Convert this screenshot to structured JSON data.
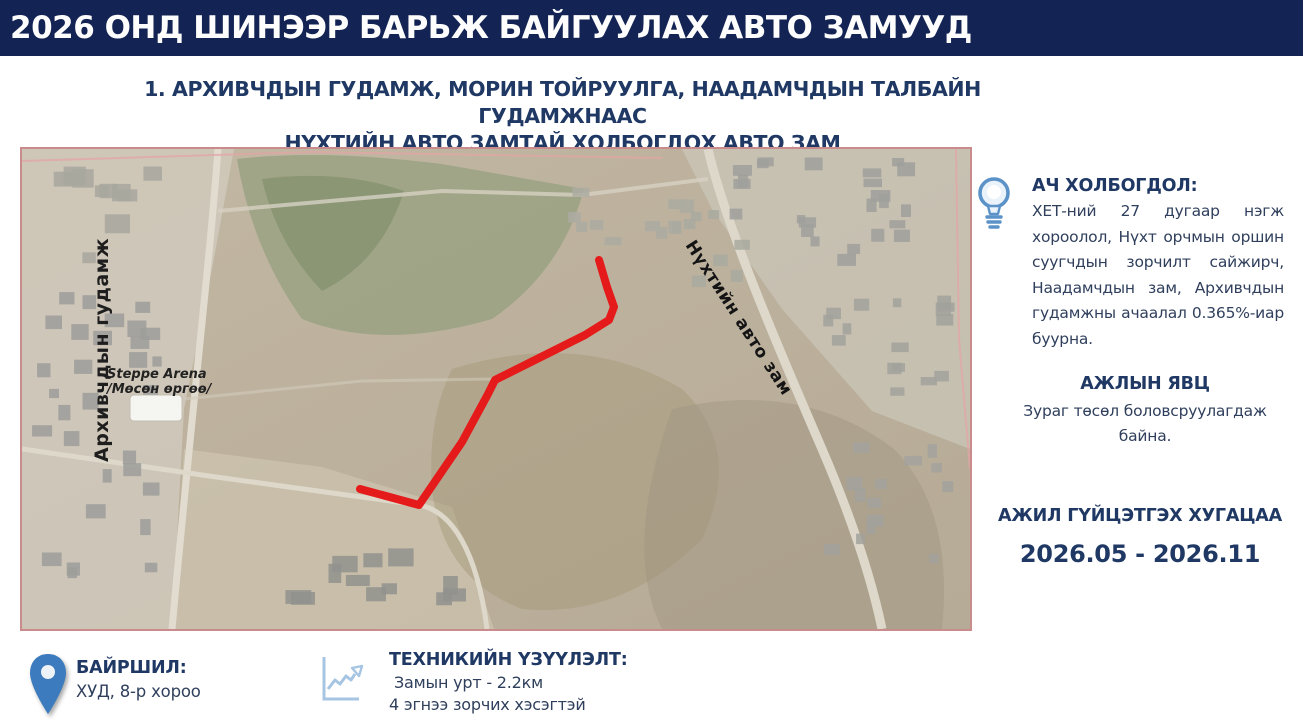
{
  "header": {
    "title": "2026 ОНД ШИНЭЭР БАРЬЖ БАЙГУУЛАХ АВТО ЗАМУУД"
  },
  "subtitle": {
    "line1": "1. АРХИВЧДЫН ГУДАМЖ, МОРИН ТОЙРУУЛГА, НААДАМЧДЫН ТАЛБАЙН ГУДАМЖНААС",
    "line2": "НҮХТИЙН АВТО ЗАМТАЙ ХОЛБОГДОХ АВТО ЗАМ"
  },
  "map": {
    "labels": {
      "street_left": "Архивчдын гудамж",
      "arena_line1": "Steppe Arena",
      "arena_line2": "/Мөсөн өргөө/",
      "road_right": "Нүхтийн авто зам"
    }
  },
  "panel": {
    "significance": {
      "icon": "lightbulb-icon",
      "heading": "АЧ ХОЛБОГДОЛ:",
      "body": "ХЕТ-ний 27 дугаар нэгж хороолол, Нүхт орчмын оршин суугчдын зорчилт сайжирч, Наадамчдын зам, Архивчдын гудамжны ачаалал 0.365%-иар буурна."
    },
    "progress": {
      "heading": "АЖЛЫН ЯВЦ",
      "body": "Зураг төсөл боловсруулагдаж байна."
    },
    "timeline": {
      "heading": "АЖИЛ ГҮЙЦЭТГЭХ ХУГАЦАА",
      "value": "2026.05 - 2026.11"
    }
  },
  "footer": {
    "location": {
      "icon": "location-pin-icon",
      "heading": "БАЙРШИЛ:",
      "value": "ХУД, 8-р хороо"
    },
    "specs": {
      "icon": "line-chart-icon",
      "heading": "ТЕХНИКИЙН ҮЗҮҮЛЭЛТ:",
      "line1": "Замын урт - 2.2км",
      "line2": "4 эгнээ зорчих хэсэгтэй"
    }
  },
  "colors": {
    "header_bg": "#132454",
    "heading_navy": "#1f3864",
    "route_red": "#e51a1a",
    "map_border_pink": "#c98b8b",
    "pin_blue": "#3c7cbe",
    "bulb_blue": "#5b93c9",
    "chart_icon_blue": "#a6c5e2"
  }
}
